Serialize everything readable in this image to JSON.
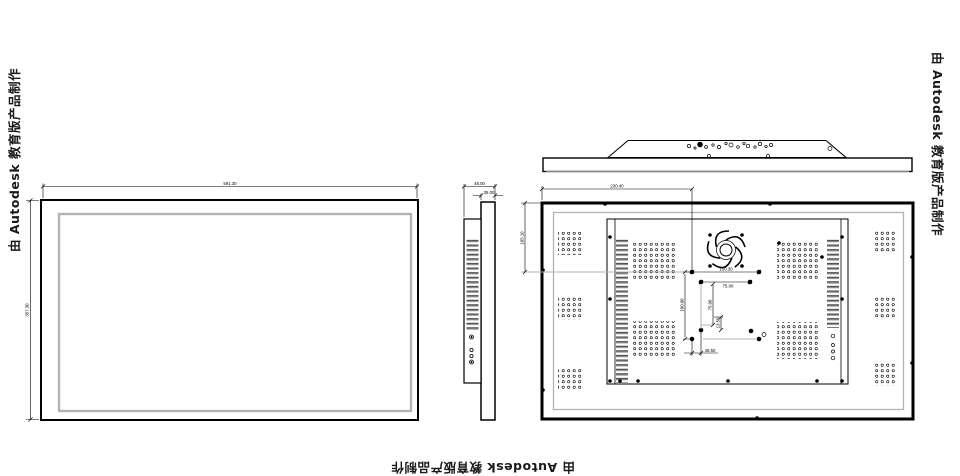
{
  "watermark": {
    "text": "由 Autodesk 教育版产品制作"
  },
  "dimensions": {
    "front": {
      "width": "591.30",
      "height": "357.30"
    },
    "side": {
      "total_depth": "48.00",
      "panel_depth": "35.00"
    },
    "back": {
      "horizontal_offset": "230.40",
      "vertical_offset": "105.10",
      "vesa_horizontal_outer": "150.30",
      "vesa_horizontal_inner": "75.00",
      "vesa_vertical_outer": "100.00",
      "vesa_vertical_inner": "75.00",
      "vesa_vertical_small": "13.50",
      "vesa_horizontal_small": "48.50"
    }
  },
  "colors": {
    "line": "#000000",
    "light_line": "#b3b3b3",
    "background": "#ffffff"
  }
}
